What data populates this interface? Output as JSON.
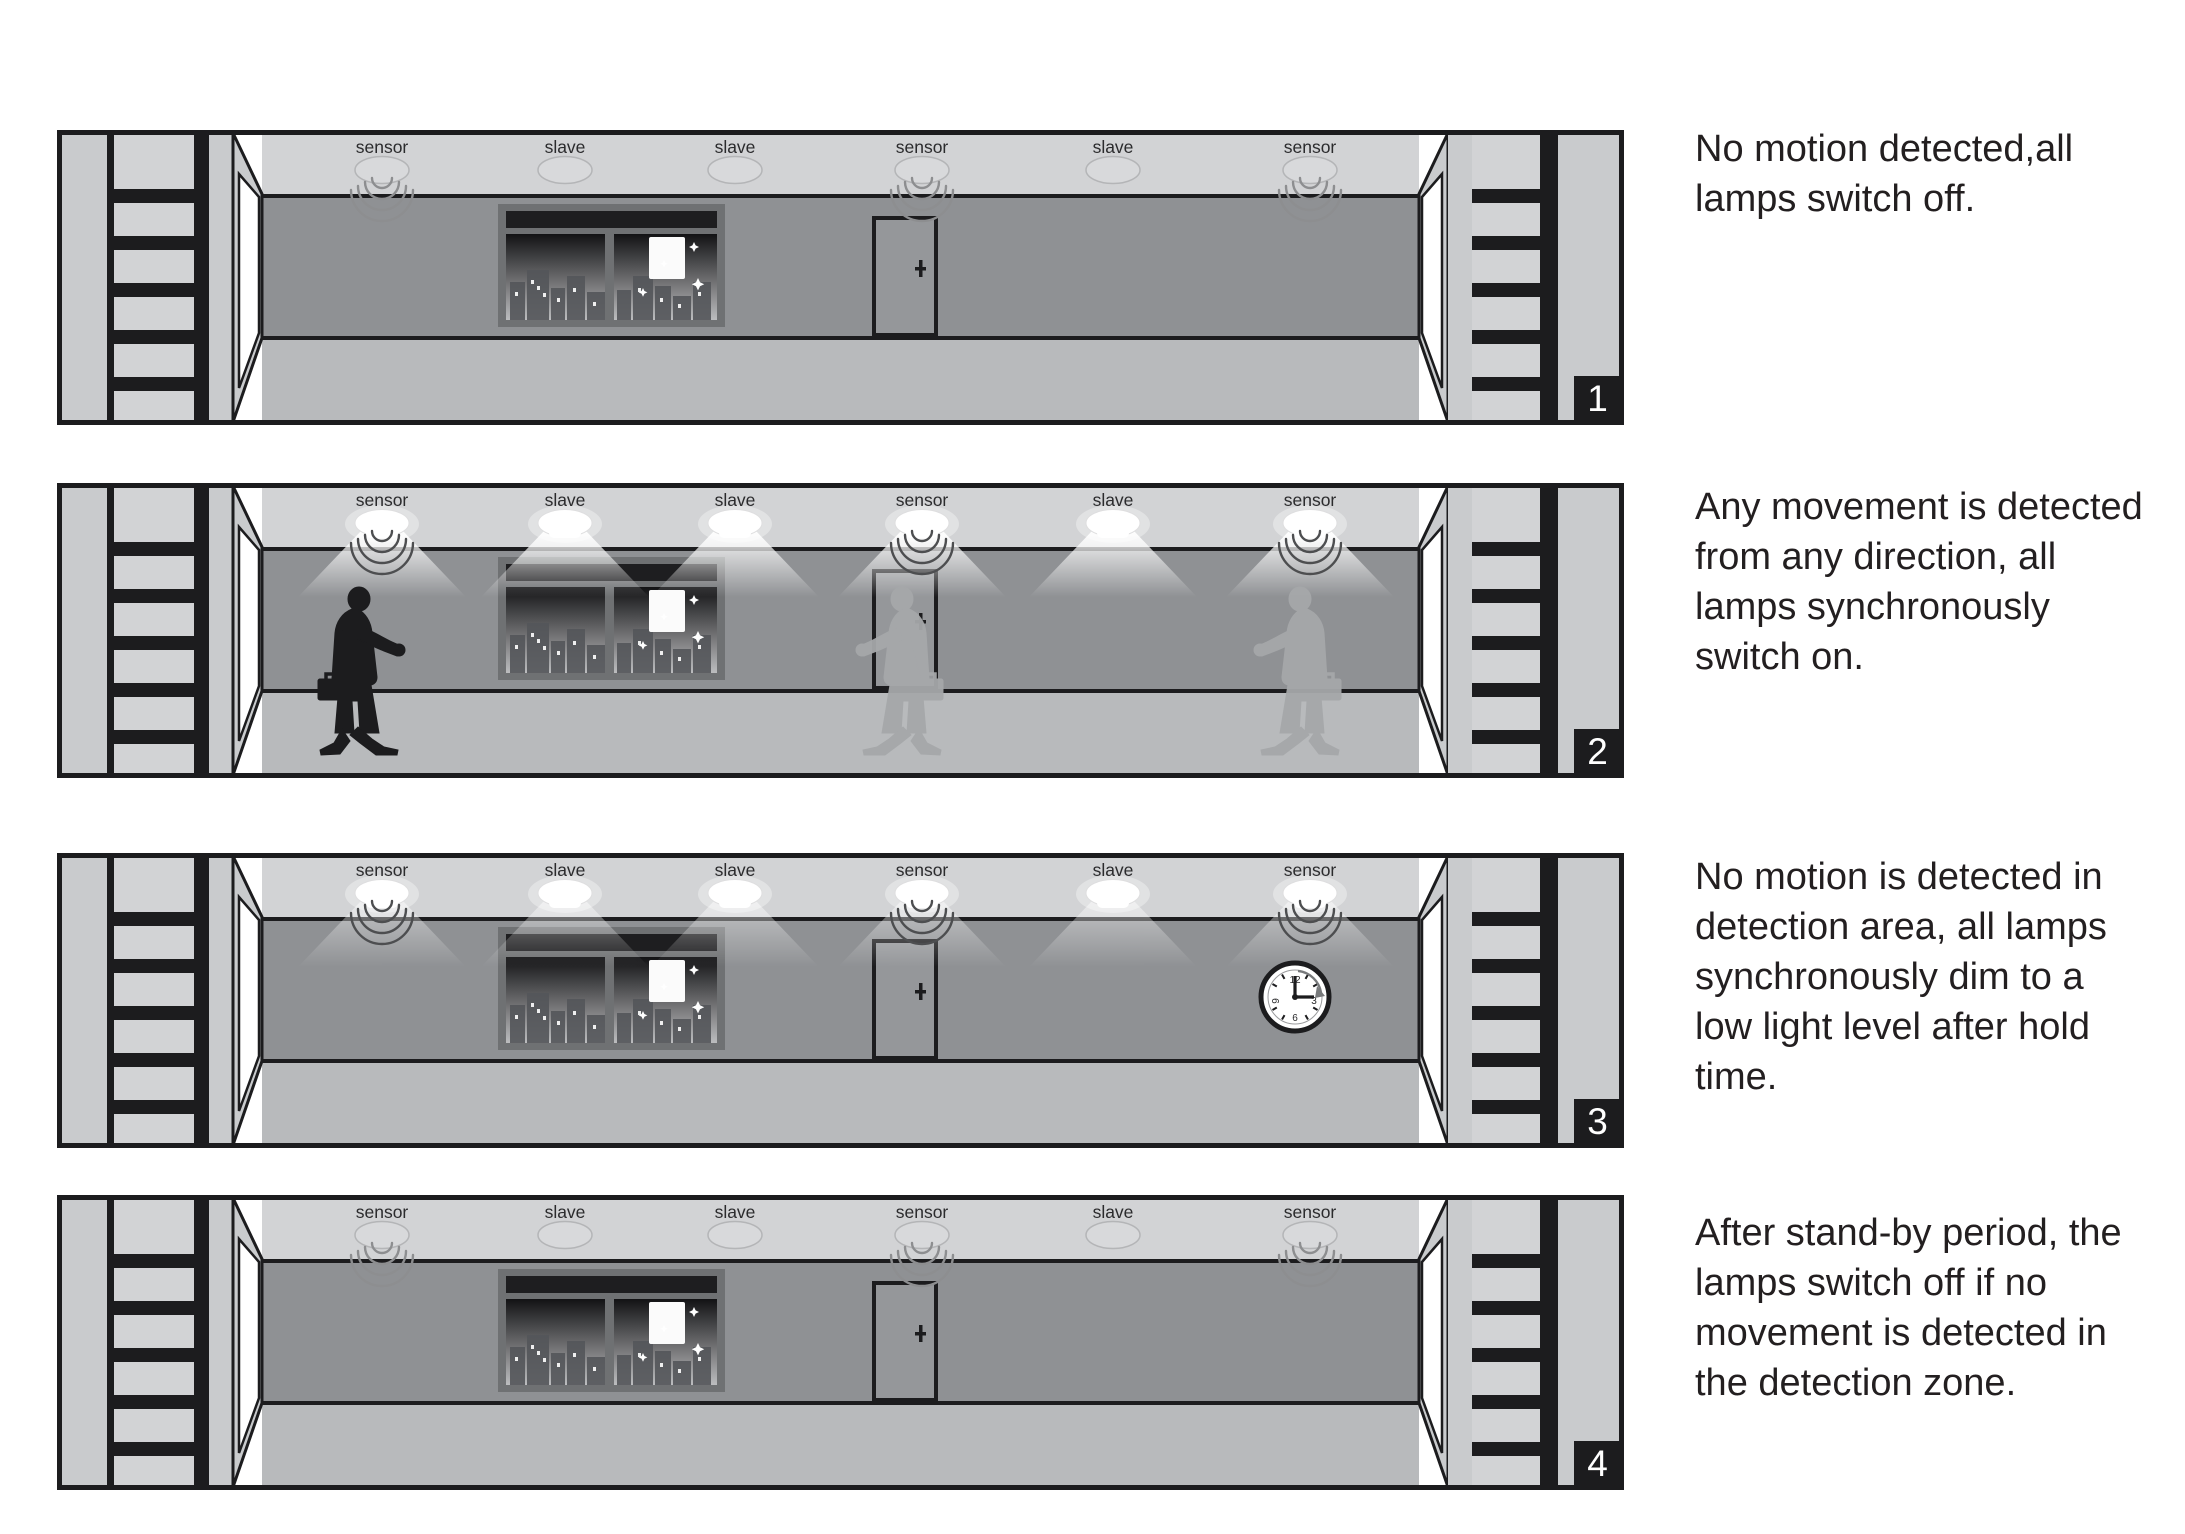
{
  "colors": {
    "background": "#ffffff",
    "line_black": "#1c1c1e",
    "ceiling": "#d2d3d5",
    "back_wall": "#8f9194",
    "floor": "#b8babc",
    "side_wall": "#c9cbcd",
    "ladder_rung": "#d2d3d5",
    "lamp_off_fill": "#d8d9db",
    "lamp_on_fill": "#ffffff",
    "beam_color": "#ffffff",
    "wave_arc_off": "#8d8e90",
    "wave_arc_on": "#4d4e50",
    "person_silhouette": "#1c1c1e",
    "ghost_person": "#a6a8aa",
    "caption_text": "#231f20",
    "badge_bg": "#1c1c1e",
    "badge_text": "#ffffff"
  },
  "panels": [
    {
      "badge": "1",
      "state": "off",
      "persons": false,
      "labels": [
        "sensor",
        "slave",
        "slave",
        "sensor",
        "slave",
        "sensor"
      ],
      "caption": "No motion detected,all\nlamps switch off."
    },
    {
      "badge": "2",
      "state": "on",
      "persons": true,
      "labels": [
        "sensor",
        "slave",
        "slave",
        "sensor",
        "slave",
        "sensor"
      ],
      "caption": "Any movement is detected\nfrom any direction, all\nlamps synchronously\nswitch on."
    },
    {
      "badge": "3",
      "state": "dim",
      "persons": false,
      "clock": {
        "numbers": [
          "12",
          "3",
          "6",
          "9"
        ]
      },
      "labels": [
        "sensor",
        "slave",
        "slave",
        "sensor",
        "slave",
        "sensor"
      ],
      "caption": "No motion is detected in\ndetection area, all lamps\nsynchronously dim to a\nlow light level after hold\ntime."
    },
    {
      "badge": "4",
      "state": "off",
      "persons": false,
      "labels": [
        "sensor",
        "slave",
        "slave",
        "sensor",
        "slave",
        "sensor"
      ],
      "caption": "After stand-by period, the\nlamps switch off if no\nmovement is detected in\nthe detection zone."
    }
  ]
}
